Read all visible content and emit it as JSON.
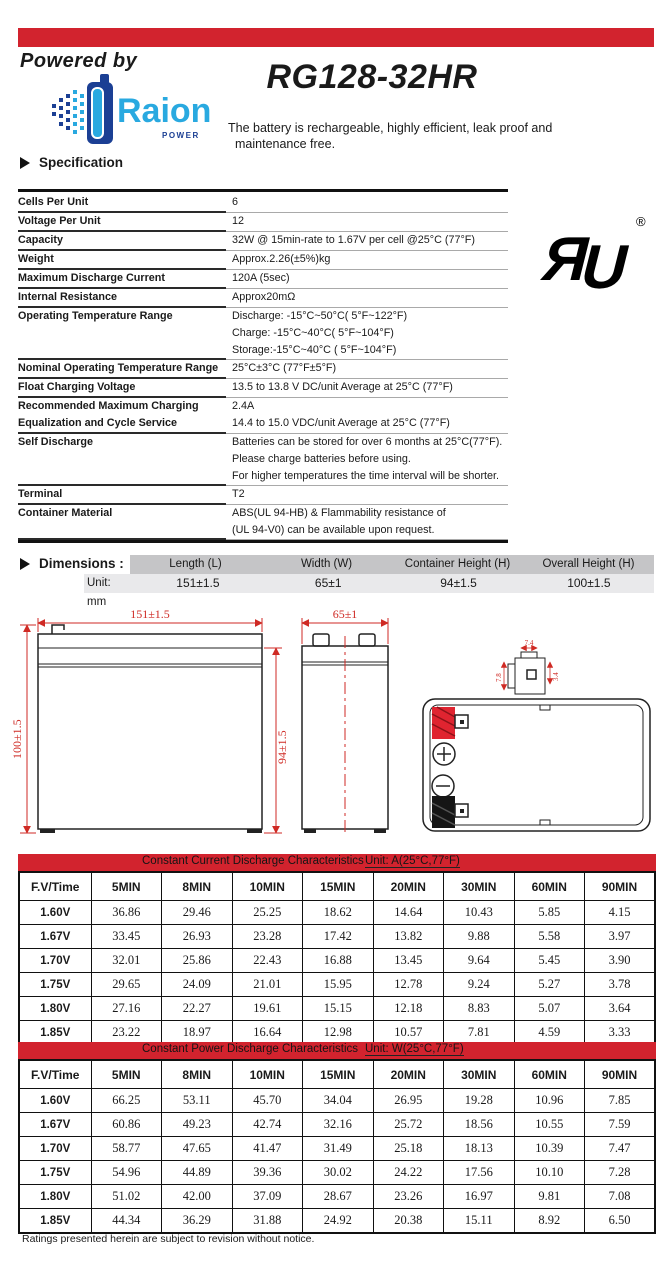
{
  "header": {
    "powered_by": "Powered by",
    "brand": "Raion",
    "brand_sub": "POWER",
    "model": "RG128-32HR",
    "description_line1": "The battery is rechargeable, highly efficient, leak proof and",
    "description_line2": "maintenance free.",
    "section_title": "Specification",
    "ul_registered": "®"
  },
  "spec_rows": [
    {
      "label": [
        "Cells Per Unit"
      ],
      "value": [
        "6"
      ]
    },
    {
      "label": [
        "Voltage Per Unit"
      ],
      "value": [
        "12"
      ]
    },
    {
      "label": [
        "Capacity"
      ],
      "value": [
        "32W @ 15min-rate to 1.67V per cell @25°C (77°F)"
      ]
    },
    {
      "label": [
        "Weight"
      ],
      "value": [
        "Approx.2.26(±5%)kg"
      ]
    },
    {
      "label": [
        "Maximum Discharge Current"
      ],
      "value": [
        "120A (5sec)"
      ]
    },
    {
      "label": [
        "Internal Resistance"
      ],
      "value": [
        "Approx20mΩ"
      ]
    },
    {
      "label": [
        "Operating Temperature Range"
      ],
      "value": [
        "Discharge: -15°C~50°C( 5°F~122°F)",
        "Charge: -15°C~40°C( 5°F~104°F)",
        "Storage:-15°C~40°C ( 5°F~104°F)"
      ]
    },
    {
      "label": [
        "Nominal Operating Temperature Range"
      ],
      "value": [
        "25°C±3°C (77°F±5°F)"
      ]
    },
    {
      "label": [
        "Float Charging Voltage"
      ],
      "value": [
        "13.5 to 13.8 V DC/unit Average at 25°C (77°F)"
      ]
    },
    {
      "label": [
        "Recommended Maximum Charging",
        "Equalization and Cycle Service"
      ],
      "value": [
        "2.4A",
        "14.4 to 15.0 VDC/unit Average at 25°C (77°F)"
      ]
    },
    {
      "label": [
        "Self Discharge"
      ],
      "value": [
        "Batteries can be stored for over 6 months at 25°C(77°F).",
        "Please charge batteries before using.",
        "For higher temperatures the time interval will be shorter."
      ]
    },
    {
      "label": [
        "Terminal"
      ],
      "value": [
        "T2"
      ]
    },
    {
      "label": [
        "Container Material"
      ],
      "value": [
        "ABS(UL 94-HB) & Flammability resistance of",
        "(UL 94-V0) can be available upon request."
      ]
    }
  ],
  "dimensions": {
    "title": "Dimensions :",
    "unit_label": "Unit: mm",
    "columns": [
      "Length (L)",
      "Width (W)",
      "Container Height (H)",
      "Overall Height (H)"
    ],
    "values": [
      "151±1.5",
      "65±1",
      "94±1.5",
      "100±1.5"
    ]
  },
  "drawings": {
    "front": {
      "width_dim": "151±1.5",
      "overall_height_dim": "100±1.5",
      "container_height_dim": "94±1.5"
    },
    "side": {
      "width_dim": "65±1"
    },
    "terminal": {
      "top_dim": "7.4",
      "left_dim": "7.8",
      "right_dim": "3.4"
    }
  },
  "tables": [
    {
      "title": "Constant Current Discharge Characteristics",
      "unit": "Unit: A(25°C,77°F)",
      "columns": [
        "F.V/Time",
        "5MIN",
        "8MIN",
        "10MIN",
        "15MIN",
        "20MIN",
        "30MIN",
        "60MIN",
        "90MIN"
      ],
      "rows": [
        {
          "fv": "1.60V",
          "values": [
            "36.86",
            "29.46",
            "25.25",
            "18.62",
            "14.64",
            "10.43",
            "5.85",
            "4.15"
          ]
        },
        {
          "fv": "1.67V",
          "values": [
            "33.45",
            "26.93",
            "23.28",
            "17.42",
            "13.82",
            "9.88",
            "5.58",
            "3.97"
          ]
        },
        {
          "fv": "1.70V",
          "values": [
            "32.01",
            "25.86",
            "22.43",
            "16.88",
            "13.45",
            "9.64",
            "5.45",
            "3.90"
          ]
        },
        {
          "fv": "1.75V",
          "values": [
            "29.65",
            "24.09",
            "21.01",
            "15.95",
            "12.78",
            "9.24",
            "5.27",
            "3.78"
          ]
        },
        {
          "fv": "1.80V",
          "values": [
            "27.16",
            "22.27",
            "19.61",
            "15.15",
            "12.18",
            "8.83",
            "5.07",
            "3.64"
          ]
        },
        {
          "fv": "1.85V",
          "values": [
            "23.22",
            "18.97",
            "16.64",
            "12.98",
            "10.57",
            "7.81",
            "4.59",
            "3.33"
          ]
        }
      ]
    },
    {
      "title": "Constant Power Discharge Characteristics",
      "unit": "Unit: W(25°C,77°F)",
      "columns": [
        "F.V/Time",
        "5MIN",
        "8MIN",
        "10MIN",
        "15MIN",
        "20MIN",
        "30MIN",
        "60MIN",
        "90MIN"
      ],
      "rows": [
        {
          "fv": "1.60V",
          "values": [
            "66.25",
            "53.11",
            "45.70",
            "34.04",
            "26.95",
            "19.28",
            "10.96",
            "7.85"
          ]
        },
        {
          "fv": "1.67V",
          "values": [
            "60.86",
            "49.23",
            "42.74",
            "32.16",
            "25.72",
            "18.56",
            "10.55",
            "7.59"
          ]
        },
        {
          "fv": "1.70V",
          "values": [
            "58.77",
            "47.65",
            "41.47",
            "31.49",
            "25.18",
            "18.13",
            "10.39",
            "7.47"
          ]
        },
        {
          "fv": "1.75V",
          "values": [
            "54.96",
            "44.89",
            "39.36",
            "30.02",
            "24.22",
            "17.56",
            "10.10",
            "7.28"
          ]
        },
        {
          "fv": "1.80V",
          "values": [
            "51.02",
            "42.00",
            "37.09",
            "28.67",
            "23.26",
            "16.97",
            "9.81",
            "7.08"
          ]
        },
        {
          "fv": "1.85V",
          "values": [
            "44.34",
            "36.29",
            "31.88",
            "24.92",
            "20.38",
            "15.11",
            "8.92",
            "6.50"
          ]
        }
      ]
    }
  ],
  "footer": "Ratings presented herein are subject to revision without notice.",
  "colors": {
    "accent_red": "#d2232e",
    "brand_blue": "#29a9e0",
    "brand_navy": "#1b3f94",
    "drawing_red": "#cf2a24"
  }
}
